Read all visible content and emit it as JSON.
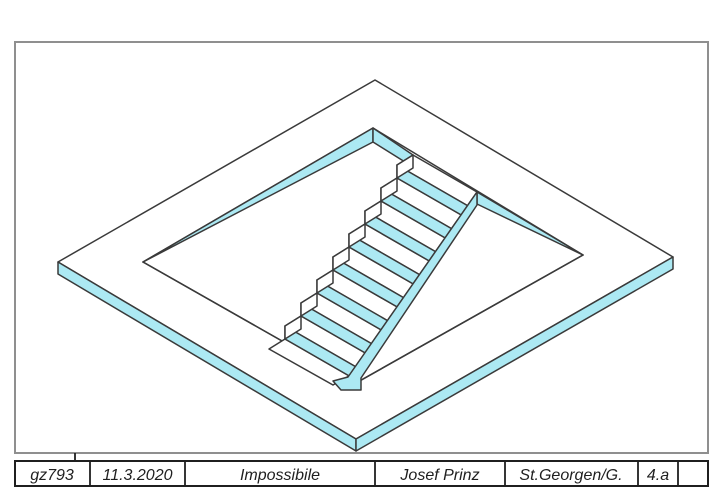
{
  "drawing": {
    "type": "isometric impossible-staircase figure in rectangular platform opening",
    "step_count": 8,
    "colors": {
      "fill": "#ace9f3",
      "line": "#3a3a3a",
      "frame": "#8f8f8f",
      "paper": "#ffffff",
      "text": "#1f1f1f"
    }
  },
  "title_block": {
    "cells": [
      {
        "id": "code",
        "label": "gz793"
      },
      {
        "id": "date",
        "label": "11.3.2020"
      },
      {
        "id": "title",
        "label": "Impossibile"
      },
      {
        "id": "name",
        "label": "Josef Prinz"
      },
      {
        "id": "place",
        "label": "St.Georgen/G."
      },
      {
        "id": "class",
        "label": "4.a"
      },
      {
        "id": "empty",
        "label": ""
      }
    ]
  }
}
